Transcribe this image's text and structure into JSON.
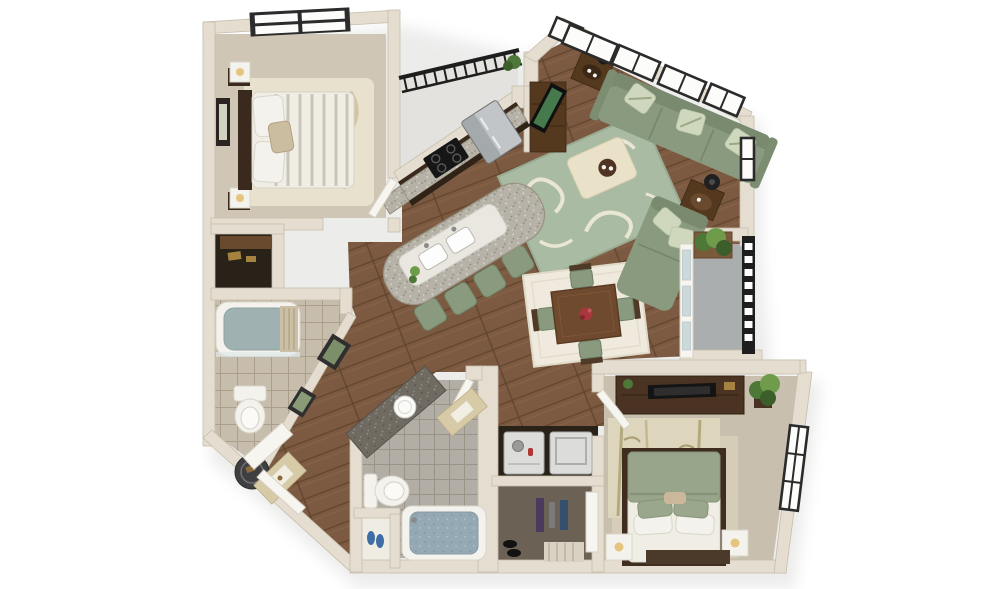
{
  "scene": {
    "type": "3d-floor-plan-render",
    "view": "isometric-top-down",
    "background": "#ffffff",
    "rooms": [
      {
        "id": "bedroom-1",
        "contents": [
          "double-bed-striped-duvet",
          "dark-headboard",
          "pillows",
          "cube-nightstand-lamps",
          "wall-art",
          "leaf-pattern-rug",
          "window-2x2"
        ]
      },
      {
        "id": "closet-1",
        "contents": [
          "shelf",
          "brass-boxes"
        ]
      },
      {
        "id": "bathroom-1",
        "contents": [
          "bathtub",
          "glass-panel",
          "bath-mat",
          "toilet",
          "beige-tile-floor",
          "framed-green-art-x2"
        ]
      },
      {
        "id": "kitchen",
        "contents": [
          "angled-counter-run",
          "upper-cabinets",
          "cooktop",
          "stainless-refrigerator",
          "granite-island",
          "double-sink",
          "bar-stools-x4"
        ]
      },
      {
        "id": "dining-area",
        "contents": [
          "square-wood-table",
          "red-centerpiece",
          "green-cushion-chairs-x4",
          "cream-area-rug"
        ]
      },
      {
        "id": "living-room",
        "contents": [
          "green-sofa",
          "throw-pillows-x3",
          "green-chaise",
          "cream-ottoman-tray",
          "scroll-pattern-rug",
          "tv-console",
          "flat-tv",
          "side-table-x2",
          "black-floor-lamp",
          "window-wall"
        ]
      },
      {
        "id": "balcony-north",
        "contents": [
          "metal-railing",
          "plant"
        ]
      },
      {
        "id": "balcony-east",
        "contents": [
          "metal-railing",
          "planter-box",
          "sliding-glass-door",
          "concrete-floor"
        ]
      },
      {
        "id": "entry-hallway",
        "contents": [
          "open-entry-door",
          "closet-door-panel",
          "console-table-tray-x2",
          "round-drum-table",
          "framed-green-art"
        ]
      },
      {
        "id": "bathroom-2",
        "contents": [
          "granite-vanity",
          "vessel-sink",
          "toilet",
          "bathtub-water",
          "gray-tile-floor",
          "slipper-closet",
          "door"
        ]
      },
      {
        "id": "laundry-closet",
        "contents": [
          "washer-with-dial",
          "dryer"
        ]
      },
      {
        "id": "walk-in-closet",
        "contents": [
          "hanging-clothes",
          "black-shoes",
          "shoe-rack",
          "white-door"
        ]
      },
      {
        "id": "bedroom-2",
        "contents": [
          "bed-green-duvet",
          "white-pillows",
          "green-pillows",
          "bamboo-accent-panel",
          "cube-nightstand-lamps-x2",
          "dresser",
          "flat-tv",
          "potted-plant",
          "area-rug",
          "foot-bench",
          "window-2x2",
          "door"
        ]
      }
    ]
  },
  "colors": {
    "wall": "#e4ddd0",
    "wallEdge": "#c6bdab",
    "wood": "#7c5a42",
    "woodDark": "#66482f",
    "tileBeige": "#c7bdac",
    "grout": "#ab9f8b",
    "tileGray": "#b2aea5",
    "groutG": "#999488",
    "carpet1": "#cfc6b5",
    "carpet2": "#c8bfae",
    "rugCream": "#e8e1cd",
    "rugLeaf": "#d3c5a2",
    "sage": "#8a9a7e",
    "sageDark": "#798a6e",
    "sageLight": "#cfd8bd",
    "rugSage": "#a9bba2",
    "rugScroll": "#e9e7d3",
    "espresso": "#3a2a1d",
    "walnut": "#54391f",
    "woodMid": "#6f4a2f",
    "granite": "#b6b2a8",
    "graniteEdge": "#97917f",
    "graniteDark": "#6f6b62",
    "white": "#f4f2ec",
    "mattress": "#f0ede5",
    "water": "#9fb1b1",
    "tubWater": "#95a9b4",
    "black": "#1e1e1e",
    "frame": "#2b2b2b",
    "pane": "#fcfcfa",
    "steel1": "#c2c5c7",
    "steel2": "#8d9193",
    "appliance": "#dcdcda",
    "applianceEdge": "#a9a9a7",
    "plant": "#4d7838",
    "plantLight": "#6f9c4b",
    "plantDark": "#3c5e2b",
    "closetDark": "#282218",
    "closetCarpet": "#6b6155",
    "glass": "#ccd9da",
    "shadow": "#9a9a96",
    "accent": "#a7373a",
    "brass": "#a5823f",
    "glow": "#e5c57e",
    "duvet": "#98a58a",
    "doorWhite": "#f7f5f0",
    "doorEdge": "#d7d1c4",
    "balcony": "#abaeae",
    "balconyLight": "#e3e2de",
    "tanTable": "#d7caa7",
    "tray": "#f2eee1",
    "blue": "#3f6ea6",
    "darkRug": "#4b392a",
    "clothes1": "#4a3b5e",
    "clothes2": "#35506e",
    "clothes3": "#7a7a7a"
  }
}
